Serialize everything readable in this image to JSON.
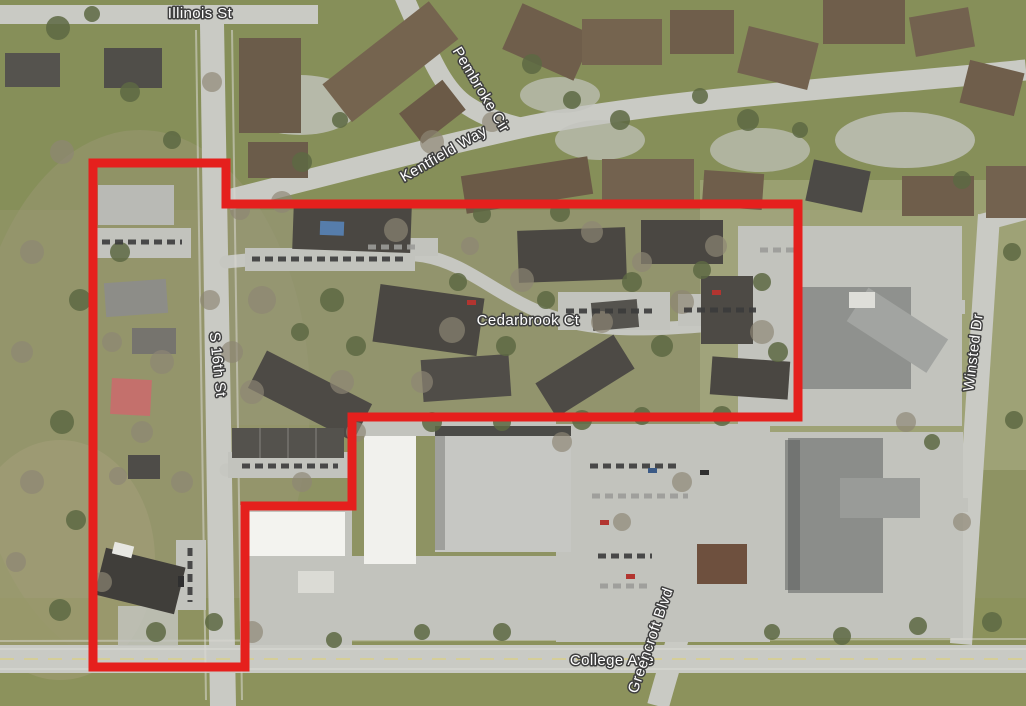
{
  "map": {
    "type": "aerial-imagery-with-site-boundary",
    "boundary": {
      "color": "#e5201d",
      "stroke_width": 9,
      "points": "93,163 226,163 226,204 798,204 798,417 352,417 352,506 245,506 245,667 93,667"
    },
    "labels": {
      "illinois_st": "Illinois St",
      "pembroke_cir": "Pembroke Cir",
      "kentfield_way": "Kentfield Way",
      "cedarbrook_ct": "Cedarbrook Ct",
      "s_16th_st": "S 16th St",
      "winsted_dr": "Winsted Dr",
      "college_ave": "College Ave",
      "greencroft_blvd": "Greencroft Blvd"
    },
    "label_style": {
      "fill": "#ffffff",
      "halo": "#3f3f3f"
    }
  }
}
